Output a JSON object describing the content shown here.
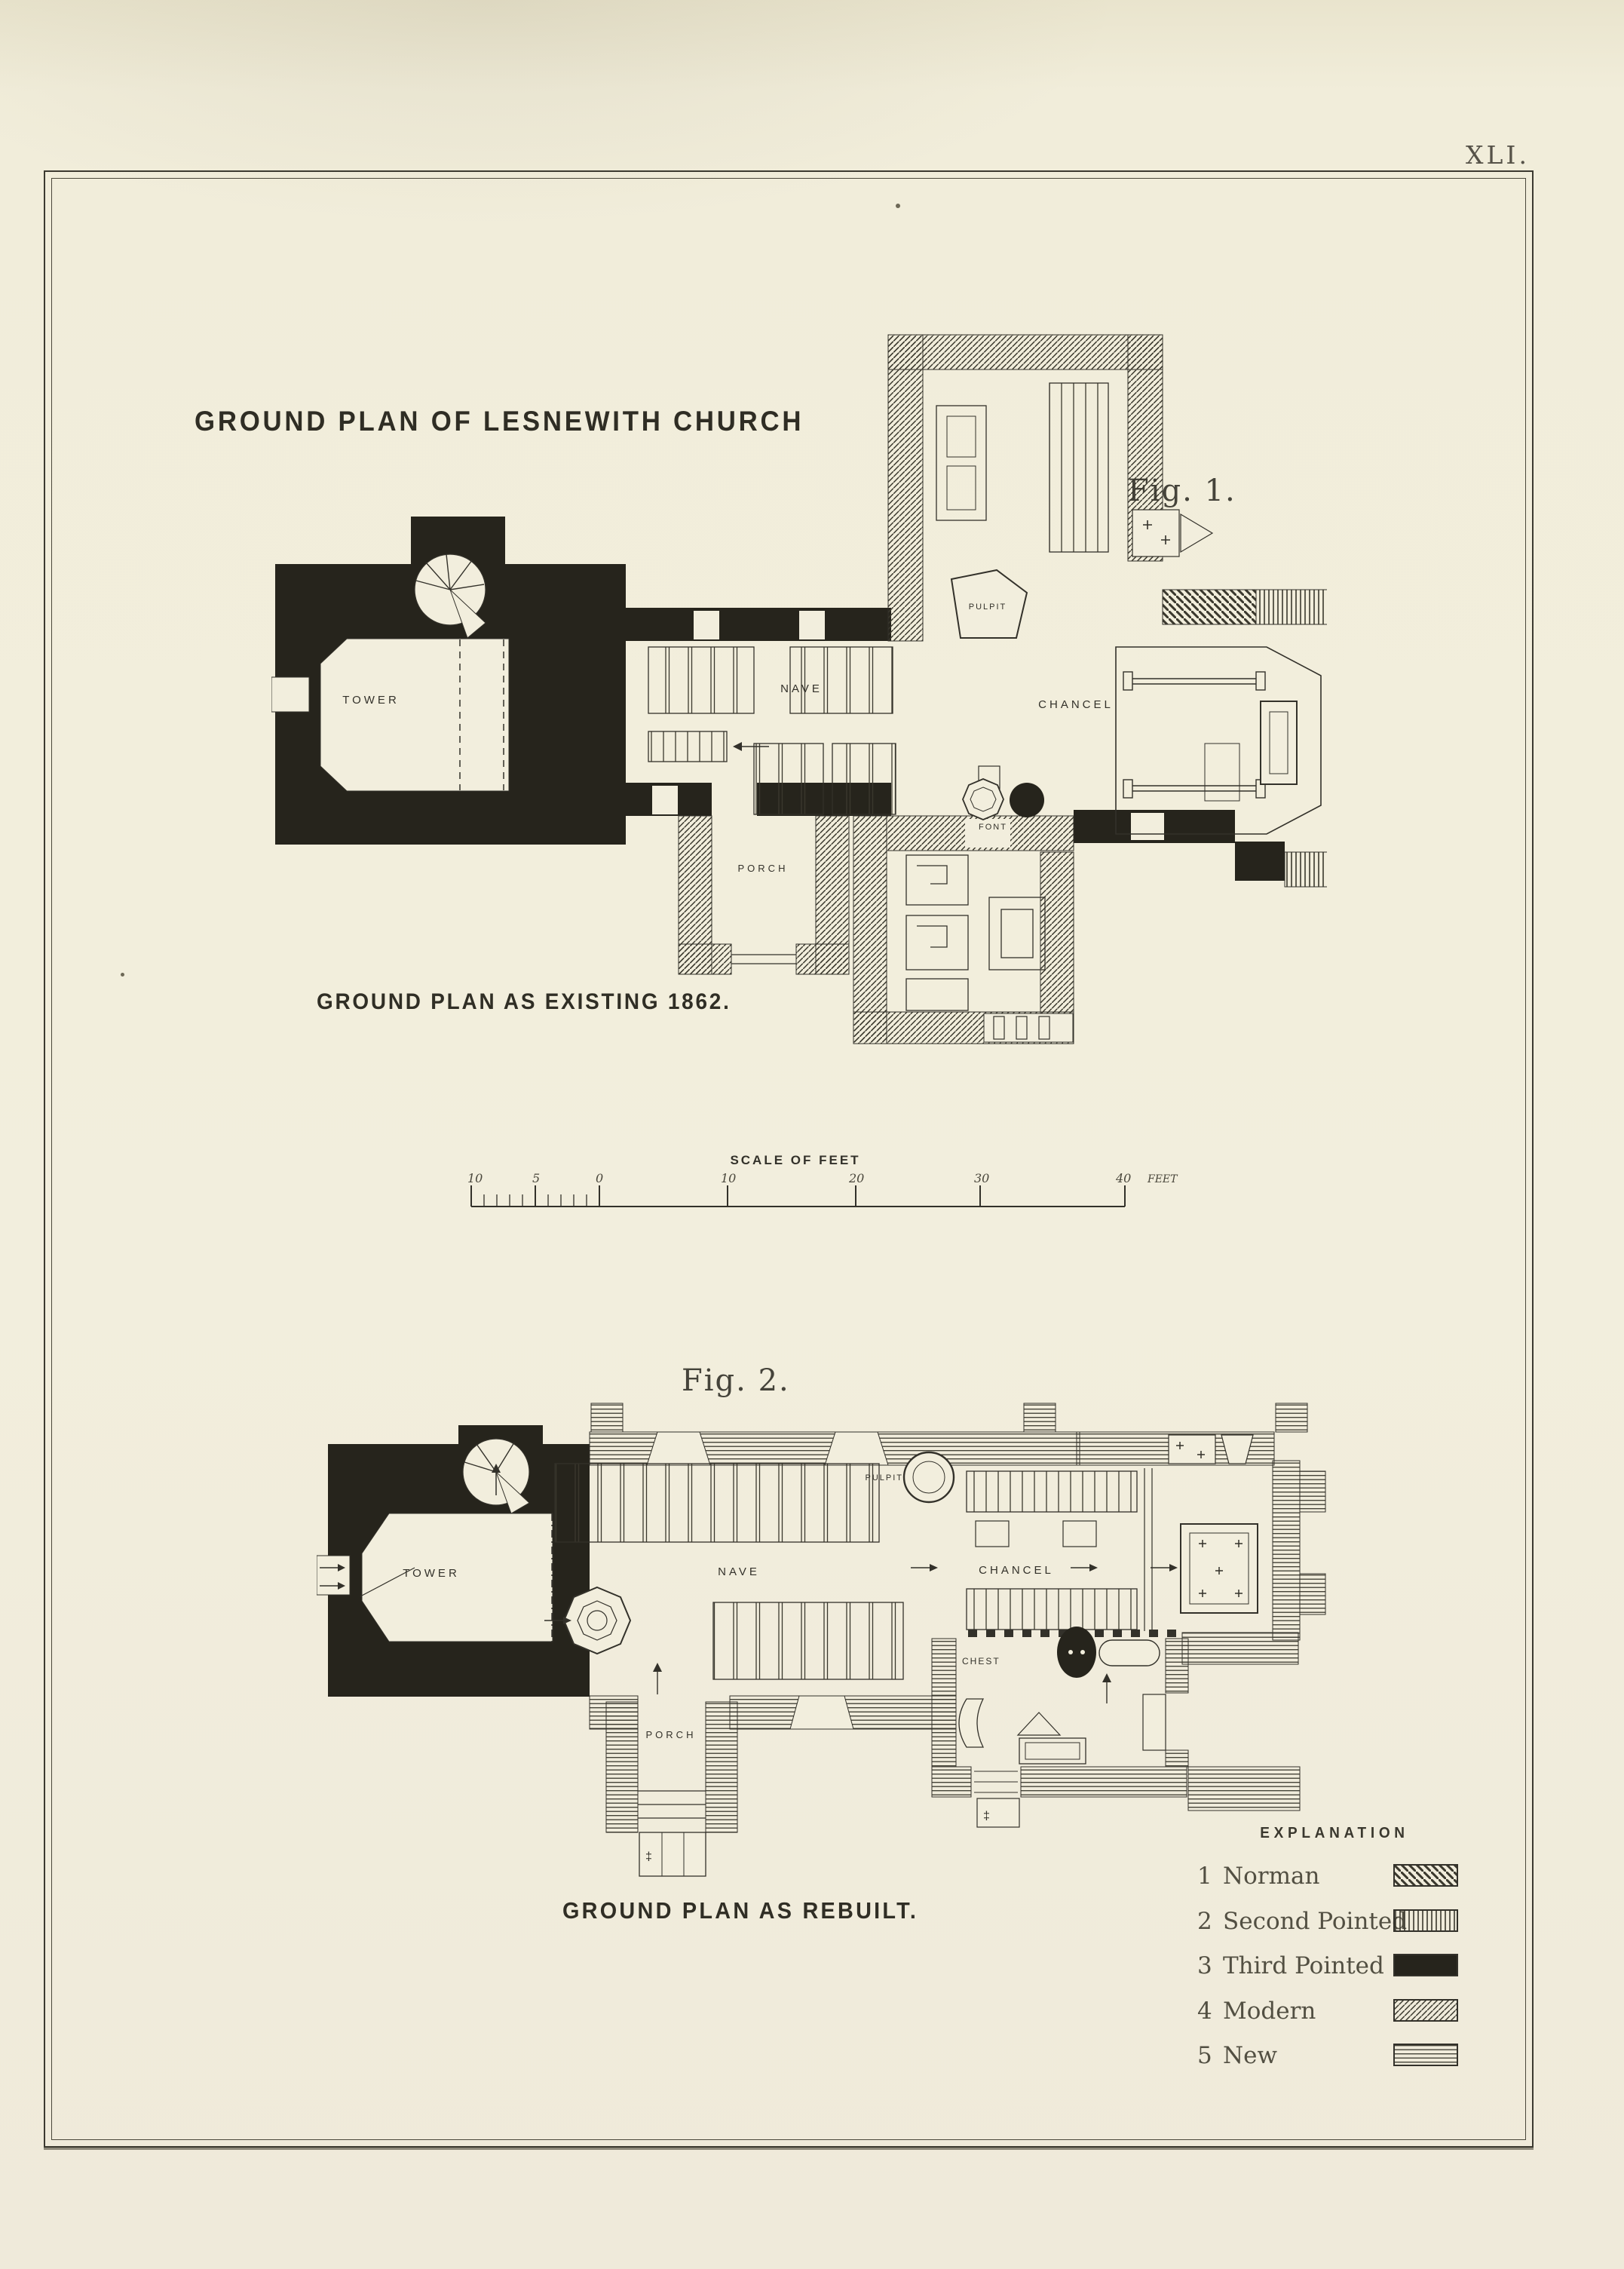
{
  "page": {
    "plate_number": "XLI.",
    "title": "GROUND PLAN OF LESNEWITH CHURCH"
  },
  "fig1": {
    "label": "Fig. 1.",
    "caption": "GROUND PLAN AS EXISTING 1862.",
    "rooms": {
      "tower": "TOWER",
      "nave": "NAVE",
      "chancel": "CHANCEL",
      "porch": "PORCH",
      "font": "FONT",
      "pulpit": "PULPIT"
    }
  },
  "fig2": {
    "label": "Fig. 2.",
    "caption": "GROUND PLAN AS REBUILT.",
    "rooms": {
      "tower": "TOWER",
      "nave": "NAVE",
      "chancel": "CHANCEL",
      "porch": "PORCH",
      "pulpit": "PULPIT",
      "chest": "CHEST"
    }
  },
  "scale": {
    "title": "SCALE OF FEET",
    "labels": [
      "10",
      "5",
      "0",
      "10",
      "20",
      "30",
      "40"
    ],
    "unit": "FEET"
  },
  "legend": {
    "title": "EXPLANATION",
    "entries": [
      {
        "number": "1",
        "label": "Norman",
        "style": "diagonal-back-hatch"
      },
      {
        "number": "2",
        "label": "Second Pointed",
        "style": "vertical-hatch"
      },
      {
        "number": "3",
        "label": "Third Pointed",
        "style": "solid-black"
      },
      {
        "number": "4",
        "label": "Modern",
        "style": "diagonal-forward-hatch"
      },
      {
        "number": "5",
        "label": "New",
        "style": "horizontal-hatch"
      }
    ]
  },
  "symbols": {
    "dagger": "‡"
  },
  "colors": {
    "paper": "#f2eedd",
    "ink": "#33312a",
    "wall_black": "#26241c"
  }
}
